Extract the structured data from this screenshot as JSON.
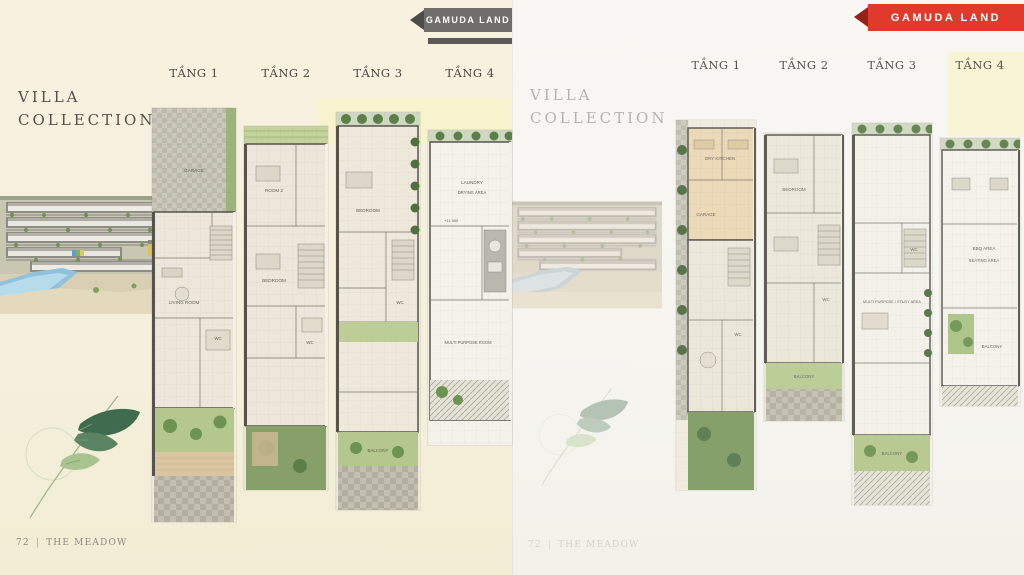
{
  "brand": {
    "name": "GAMUDA LAND"
  },
  "colors": {
    "brand_red": "#e03a2c",
    "ribbon_gray": "#6f6e6c",
    "page_left_bg": "#f5f0dc",
    "page_right_bg": "#f6f5f0",
    "plan_green": "#b4c78c",
    "water_blue": "#8fc3dd"
  },
  "pages": {
    "left": {
      "title_line1": "VILLA",
      "title_line2": "COLLECTION",
      "footer": {
        "page_no": "72",
        "separator": "|",
        "project": "THE MEADOW"
      },
      "floors": [
        {
          "label": "TẦNG 1",
          "rooms": [
            "GARAGE",
            "LIVING ROOM",
            "WC"
          ]
        },
        {
          "label": "TẦNG 2",
          "rooms": [
            "ROOM 2",
            "BEDROOM",
            "WC"
          ]
        },
        {
          "label": "TẦNG 3",
          "rooms": [
            "BEDROOM",
            "WC",
            "BALCONY"
          ]
        },
        {
          "label": "TẦNG 4",
          "rooms": [
            "LAUNDRY",
            "DRYING AREA",
            "MULTI PURPOSE ROOM"
          ],
          "level": "+11.500"
        }
      ]
    },
    "right": {
      "title_line1": "VILLA",
      "title_line2": "COLLECTION",
      "footer": {
        "page_no": "72",
        "separator": "|",
        "project": "THE MEADOW"
      },
      "floors": [
        {
          "label": "TẦNG 1",
          "rooms": [
            "DRY KITCHEN",
            "GARAGE",
            "WC"
          ]
        },
        {
          "label": "TẦNG 2",
          "rooms": [
            "BEDROOM",
            "WC",
            "BALCONY"
          ]
        },
        {
          "label": "TẦNG 3",
          "rooms": [
            "MULTI PURPOSE / STUDY AREA",
            "WC",
            "BALCONY"
          ]
        },
        {
          "label": "TẦNG 4",
          "rooms": [
            "BBQ AREA",
            "SEATING AREA",
            "BALCONY"
          ]
        }
      ]
    }
  }
}
